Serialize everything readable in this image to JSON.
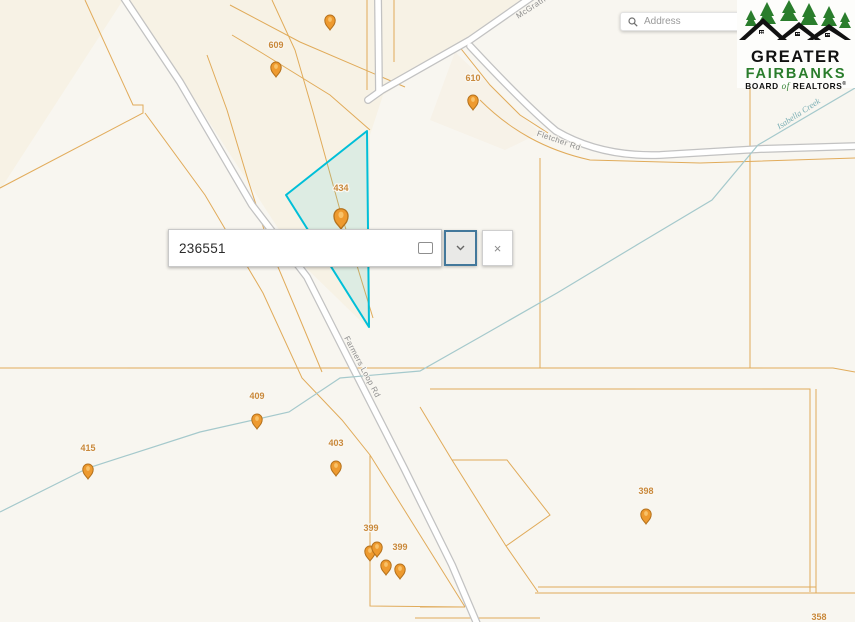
{
  "map": {
    "selected_parcel": "434",
    "parcel_labels": [
      {
        "text": "609",
        "x": 276,
        "y": 48
      },
      {
        "text": "610",
        "x": 473,
        "y": 81
      },
      {
        "text": "434",
        "x": 341,
        "y": 191
      },
      {
        "text": "409",
        "x": 257,
        "y": 399
      },
      {
        "text": "415",
        "x": 88,
        "y": 451
      },
      {
        "text": "403",
        "x": 336,
        "y": 446
      },
      {
        "text": "399",
        "x": 371,
        "y": 531
      },
      {
        "text": "399",
        "x": 400,
        "y": 550
      },
      {
        "text": "398",
        "x": 646,
        "y": 494
      },
      {
        "text": "358",
        "x": 819,
        "y": 620
      }
    ],
    "pins": [
      {
        "x": 330,
        "y": 30
      },
      {
        "x": 276,
        "y": 77
      },
      {
        "x": 473,
        "y": 110
      },
      {
        "x": 341,
        "y": 229,
        "large": true
      },
      {
        "x": 257,
        "y": 429
      },
      {
        "x": 88,
        "y": 479
      },
      {
        "x": 336,
        "y": 476
      },
      {
        "x": 370,
        "y": 561
      },
      {
        "x": 377,
        "y": 557
      },
      {
        "x": 386,
        "y": 575
      },
      {
        "x": 400,
        "y": 579
      },
      {
        "x": 646,
        "y": 524
      }
    ],
    "road_labels": [
      {
        "text": "Farmers Loop Rd",
        "x": 360,
        "y": 368,
        "rotate": 62
      },
      {
        "text": "Fletcher Rd",
        "x": 558,
        "y": 143,
        "rotate": 19
      },
      {
        "text": "McGrath Rd",
        "x": 538,
        "y": 6,
        "rotate": -33
      }
    ],
    "creek_label": {
      "text": "Isabella Creek",
      "x": 800,
      "y": 116,
      "rotate": -33
    }
  },
  "search": {
    "placeholder": "Address"
  },
  "member_lookup": {
    "value": "236551",
    "close_label": "×"
  },
  "logo": {
    "line1": "GREATER",
    "line2": "FAIRBANKS",
    "line3_a": "BOARD",
    "line3_of": "of",
    "line3_b": "REALTORS",
    "reg": "®"
  },
  "colors": {
    "parcel_line": "#dfa54e",
    "parcel_label": "#c9893b",
    "selected_outline": "#00bfd8",
    "selected_fill": "rgba(0,190,216,0.10)",
    "road_casing": "#c2c2c2",
    "creek": "#a5c9cc",
    "pin_fill": "#ee9a2f",
    "pin_stroke": "#b5721d",
    "logo_green": "#2a7d2c"
  }
}
